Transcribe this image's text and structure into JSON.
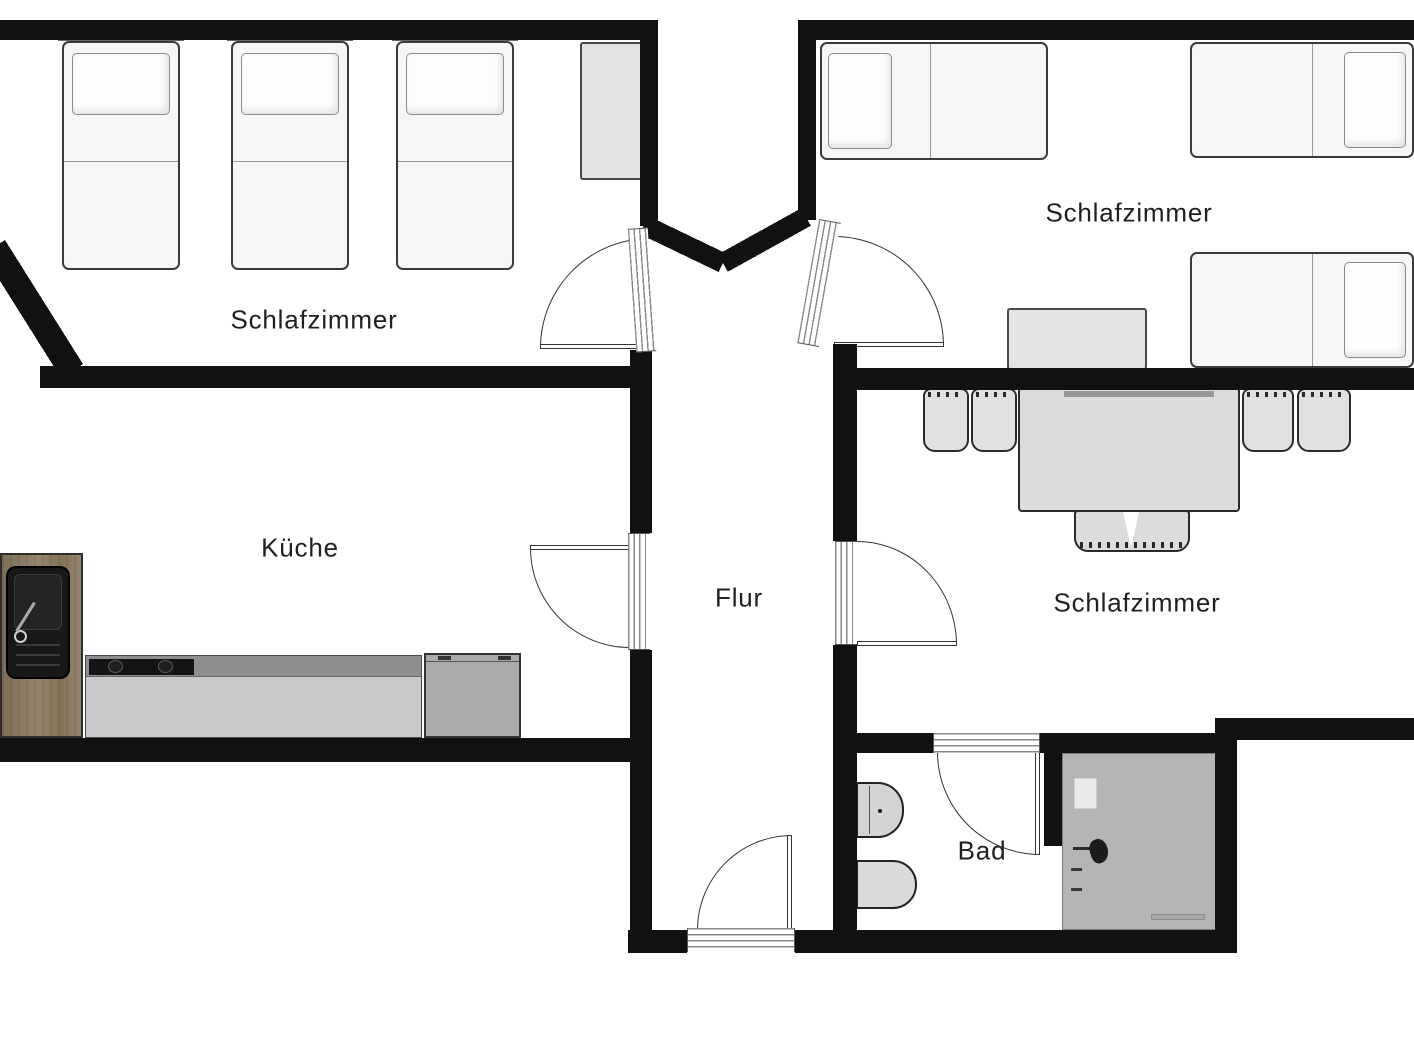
{
  "rooms": [
    {
      "id": "bedroom-left",
      "label": "Schlafzimmer"
    },
    {
      "id": "bedroom-top-right",
      "label": "Schlafzimmer"
    },
    {
      "id": "bedroom-bottom-right",
      "label": "Schlafzimmer"
    },
    {
      "id": "kitchen",
      "label": "Küche"
    },
    {
      "id": "hallway",
      "label": "Flur"
    },
    {
      "id": "bathroom",
      "label": "Bad"
    }
  ],
  "colors": {
    "wall": "#111111",
    "label_text": "#1f1f1f",
    "bed_white": "#f6f6f6",
    "sofa_gray": "#dcdcdc",
    "shower_gray": "#b5b5b5",
    "counter_gray": "#c9c9c9",
    "appliance_gray": "#ababab",
    "wood_brown": "#8d7c64",
    "sink_black": "#181818"
  },
  "furniture": [
    "single-bed",
    "single-bed",
    "single-bed",
    "wardrobe",
    "double-bed",
    "double-bed",
    "double-bed",
    "side-table",
    "sofa-with-pillows",
    "dining-kitchen-counter",
    "sink",
    "cooktop",
    "dishwasher",
    "toilet",
    "bidet",
    "shower"
  ]
}
